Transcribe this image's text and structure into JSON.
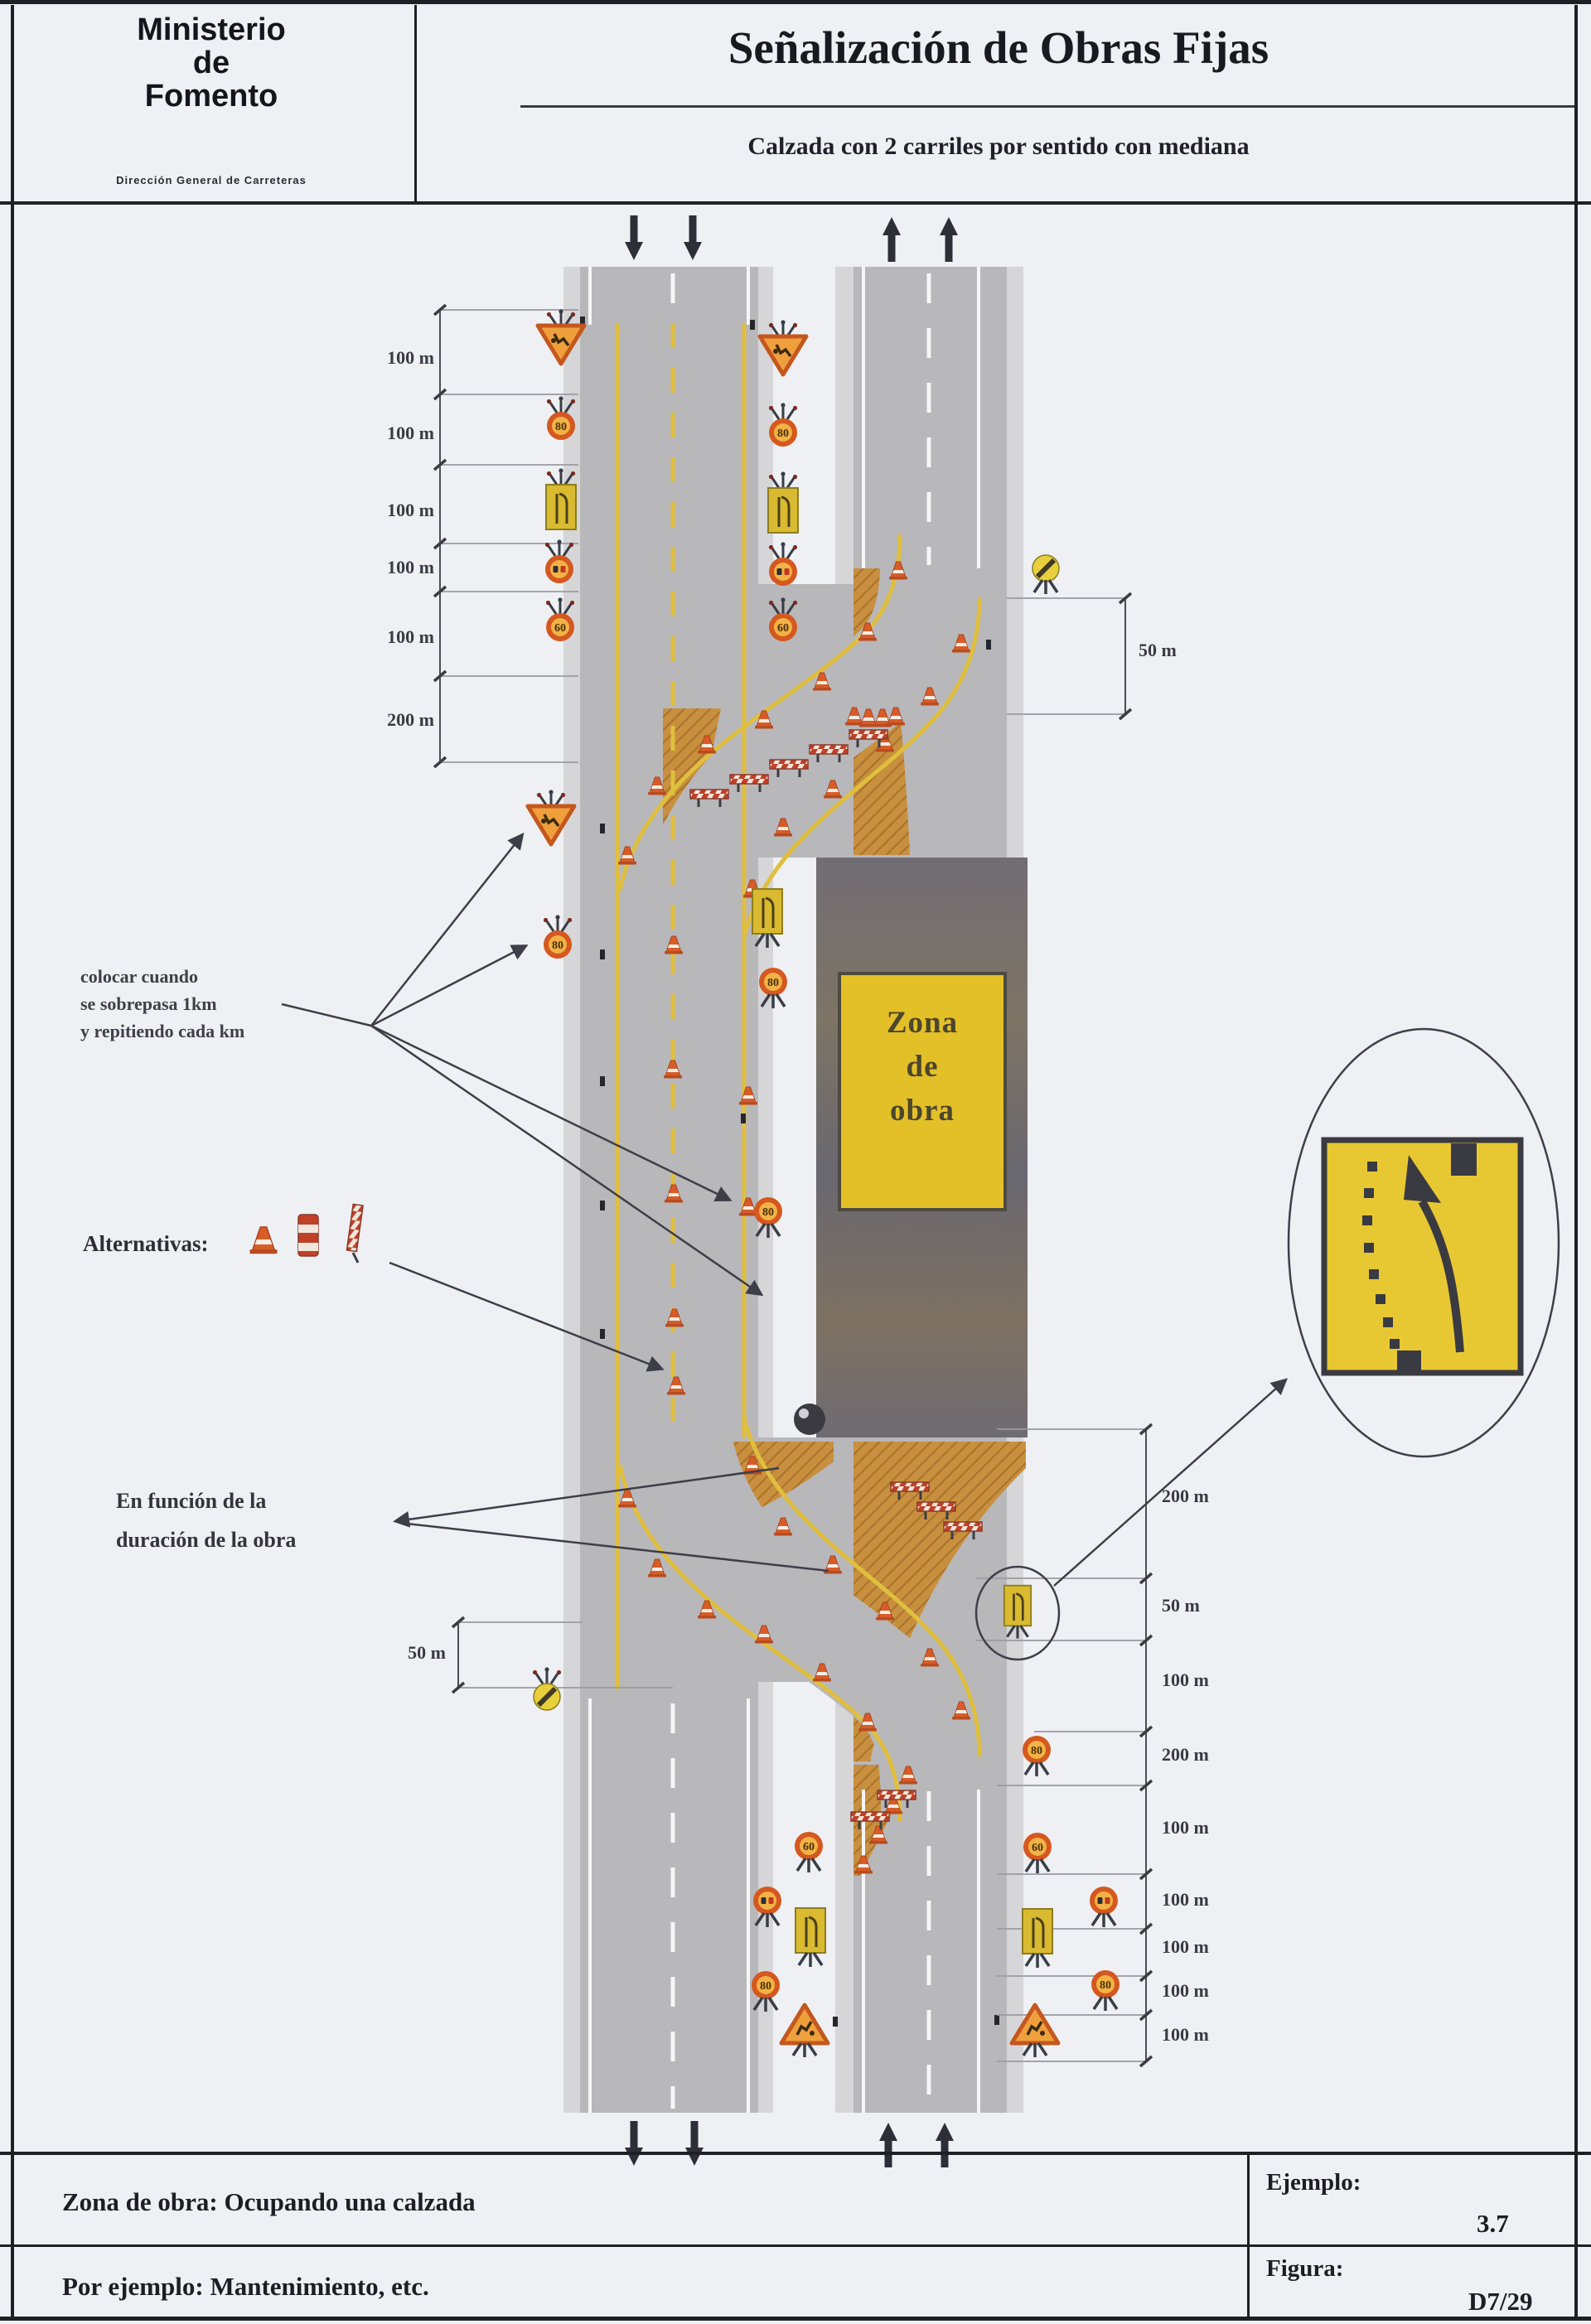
{
  "header": {
    "ministry": {
      "line1": "Ministerio",
      "line2": "de",
      "line3": "Fomento",
      "department": "Dirección General de Carreteras"
    },
    "title": "Señalización de Obras Fijas",
    "subtitle": "Calzada con 2 carriles por sentido con mediana"
  },
  "diagram": {
    "work_zone_label": {
      "line1": "Zona",
      "line2": "de",
      "line3": "obra"
    },
    "annotations": {
      "repeat_note": {
        "line1": "colocar cuando",
        "line2": "se sobrepasa 1km",
        "line3": "y repitiendo cada km"
      },
      "alternatives_label": "Alternativas:",
      "duration_note": {
        "line1": "En función de la",
        "line2": "duración de la obra"
      }
    },
    "dimensions": {
      "left_chain": [
        "100 m",
        "100 m",
        "100 m",
        "100 m",
        "100 m",
        "200 m"
      ],
      "right_top": "50 m",
      "left_bottom": "50 m",
      "right_chain": [
        "200 m",
        "50 m",
        "100 m",
        "200 m",
        "100 m",
        "100 m",
        "100 m",
        "100 m",
        "100 m"
      ]
    },
    "signs": {
      "speed_values": [
        "80",
        "60"
      ],
      "legend": [
        "works-warning-triangle",
        "speed-limit",
        "lane-closed-panel",
        "no-overtaking",
        "end-of-restrictions",
        "lane-shift-detail-panel",
        "cone",
        "barrier",
        "delineator-post"
      ]
    }
  },
  "footer": {
    "description": "Zona de obra: Ocupando una calzada",
    "example_label": "Ejemplo:",
    "example_value": "3.7",
    "note": "Por ejemplo: Mantenimiento, etc.",
    "figure_label": "Figura:",
    "figure_value": "D7/29"
  },
  "colors": {
    "road": "#b8b7ba",
    "shoulder": "#d6d6d8",
    "closed_area": "#c8903e",
    "works_zone": "#6e6a72",
    "sign_yellow": "#e3c028",
    "sign_orange": "#d4581f",
    "marking_yellow": "#e0bf3e",
    "ink": "#1f1f26"
  }
}
